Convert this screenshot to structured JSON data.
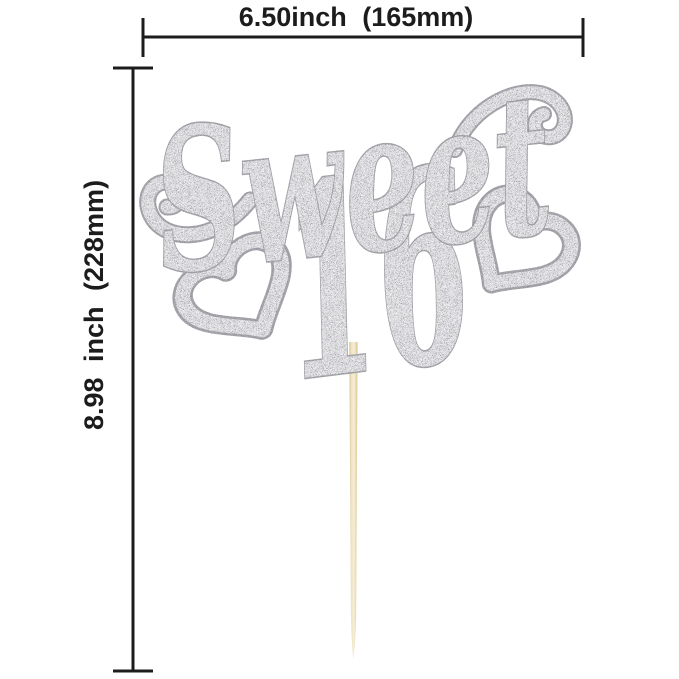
{
  "dimensions": {
    "width_label": "6.50inch (165mm)",
    "height_label": "8.98 inch (228mm)"
  },
  "topper": {
    "word": "Sweet",
    "number": "16",
    "material": "silver glitter",
    "decorations": [
      "heart-left",
      "heart-right",
      "flourish-left",
      "flourish-right"
    ],
    "stick": "wooden pick"
  },
  "colors": {
    "annotation": "#1c1c1c",
    "background": "#ffffff",
    "glitter_base": "#ededef",
    "glitter_outline": "#a9a9af",
    "glitter_speckle": "#85858d",
    "stick_light": "#f5eed8",
    "stick_dark": "#cdb987"
  }
}
